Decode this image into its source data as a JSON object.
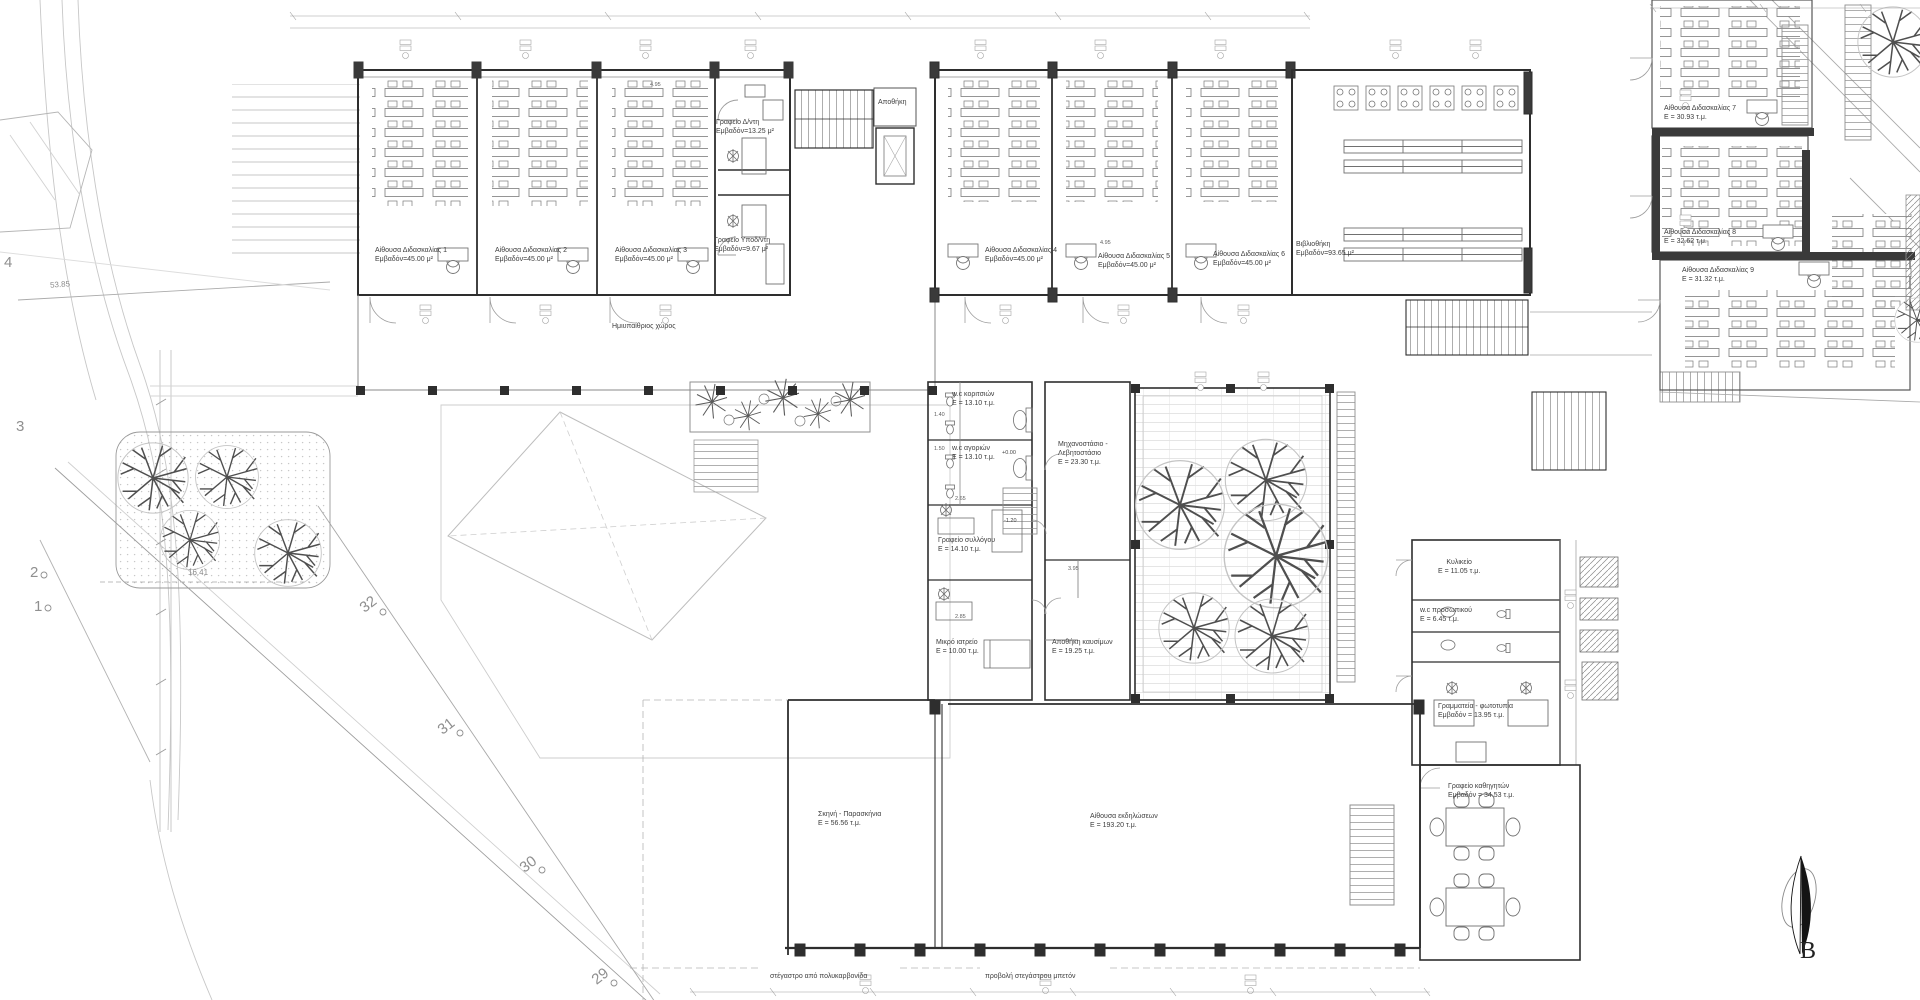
{
  "document": {
    "type": "architectural floor plan",
    "language": "el"
  },
  "rooms": {
    "classroom1": {
      "name": "Αίθουσα Διδασκαλίας 1",
      "area": "Εμβαδόν=45.00 μ²"
    },
    "classroom2": {
      "name": "Αίθουσα Διδασκαλίας 2",
      "area": "Εμβαδόν=45.00 μ²"
    },
    "classroom3": {
      "name": "Αίθουσα Διδασκαλίας 3",
      "area": "Εμβαδόν=45.00 μ²"
    },
    "classroom4": {
      "name": "Αίθουσα Διδασκαλίας 4",
      "area": "Εμβαδόν=45.00 μ²"
    },
    "classroom5": {
      "name": "Αίθουσα Διδασκαλίας 5",
      "area": "Εμβαδόν=45.00 μ²"
    },
    "classroom6": {
      "name": "Αίθουσα Διδασκαλίας 6",
      "area": "Εμβαδόν=45.00 μ²"
    },
    "classroom7": {
      "name": "Αίθουσα Διδασκαλίας 7",
      "area": "Ε = 30.93 τ.μ."
    },
    "classroom8": {
      "name": "Αίθουσα Διδασκαλίας 8",
      "area": "Ε = 32.62 τ.μ."
    },
    "classroom9": {
      "name": "Αίθουσα Διδασκαλίας 9",
      "area": "Ε = 31.32 τ.μ."
    },
    "director_office": {
      "name": "Γραφείο Δ/ντη",
      "area": "Εμβαδόν=13.25 μ²"
    },
    "deputy_office": {
      "name": "Γραφείο Υποδ/ντη",
      "area": "Εμβαδόν=9.67 μ²"
    },
    "storage": {
      "name": "Αποθήκη",
      "area": ""
    },
    "library": {
      "name": "Βιβλιοθήκη",
      "area": "Εμβαδόν=93.65 μ²"
    },
    "wc_girls": {
      "name": "w.c κοριτσιών",
      "area": "Ε = 13.10 τ.μ."
    },
    "wc_boys": {
      "name": "w.c αγοριών",
      "area": "Ε = 13.10 τ.μ."
    },
    "boiler_room": {
      "name": "Μηχανοστάσιο - Λεβητοστάσιο",
      "area": "Ε = 23.30 τ.μ."
    },
    "association_office": {
      "name": "Γραφείο συλλόγου",
      "area": "Ε = 14.10 τ.μ."
    },
    "infirmary": {
      "name": "Μικρό ιατρείο",
      "area": "Ε = 10.00 τ.μ."
    },
    "fuel_storage": {
      "name": "Αποθήκη καυσίμων",
      "area": "Ε = 19.25 τ.μ."
    },
    "canteen": {
      "name": "Κυλικείο",
      "area": "Ε = 11.05 τ.μ."
    },
    "staff_wc": {
      "name": "w.c προσωπικού",
      "area": "Ε = 6.45 τ.μ."
    },
    "secretariat": {
      "name": "Γραμματεία - φωτοτυπία",
      "area": "Εμβαδόν = 13.95 τ.μ."
    },
    "teachers_office": {
      "name": "Γραφείο καθηγητών",
      "area": "Εμβαδόν = 34.53 τ.μ."
    },
    "stage": {
      "name": "Σκηνή - Παρασκήνια",
      "area": "Ε = 56.56 τ.μ."
    },
    "event_hall": {
      "name": "Αίθουσα εκδηλώσεων",
      "area": "Ε = 193.20 τ.μ."
    }
  },
  "annotations": {
    "semi_open": "Ημιυπαίθριος χώρος",
    "canopy_polycarbonate": "στέγαστρο από πολυκαρβονίδα",
    "canopy_concrete": "προβολή στεγάστρου μπετόν",
    "level_zero": "+0.00",
    "level_minus": "-1.20",
    "north_letter": "Β"
  },
  "site": {
    "grid_numbers": [
      "4",
      "3",
      "2",
      "1",
      "32",
      "31",
      "30",
      "29"
    ],
    "dim_diagonal": "53.85",
    "dim_bottom": "16.41"
  },
  "small_dimensions": [
    "4.95",
    "3.95",
    "2.85",
    "2.65",
    "1.50",
    "1.40"
  ],
  "colors": {
    "paper": "#ffffff",
    "line_dark": "#2e2e2e",
    "line_mid": "#6f6f6f",
    "line_light": "#bcbcbc",
    "wall_fill": "#3a3a3a",
    "text": "#3d3d3d"
  }
}
